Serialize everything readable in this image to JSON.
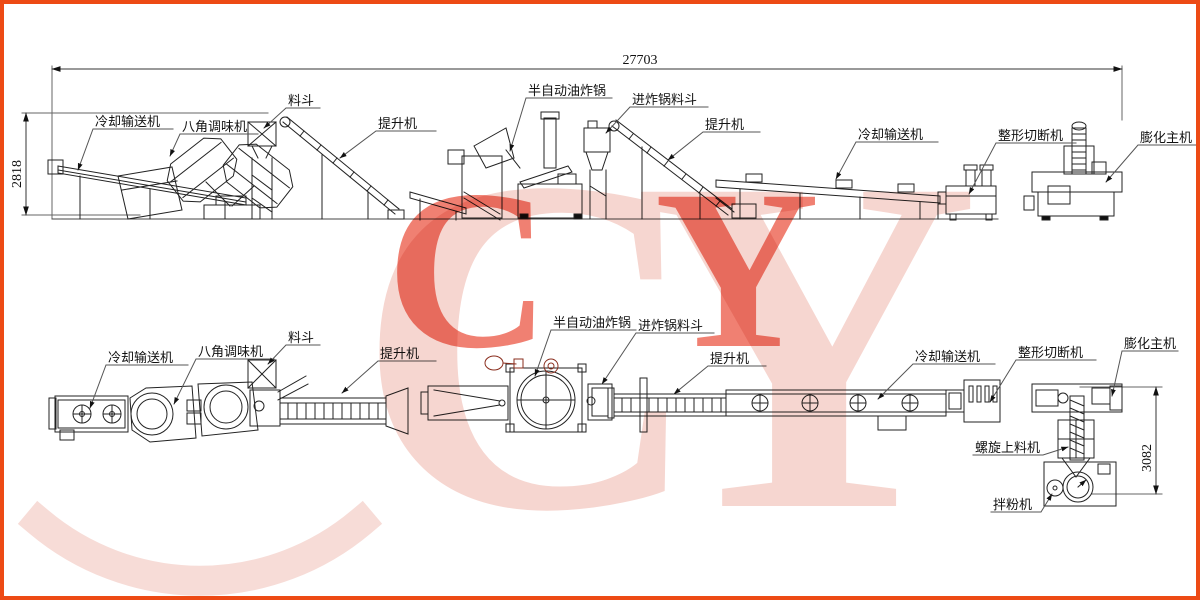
{
  "page": {
    "border_color": "#ed4a15",
    "background_color": "#ffffff",
    "line_color": "#222222",
    "accent_line_color": "#8a2e1e"
  },
  "watermark": {
    "text": "CY",
    "large_color": "#f6d6d0",
    "accent_color": "#ec604e"
  },
  "dimensions": {
    "overall_length": "27703",
    "elevation_height": "2818",
    "plan_right_height": "3082"
  },
  "elevation": {
    "labels": [
      {
        "machine": "cooling-conveyor",
        "text": "冷却输送机"
      },
      {
        "machine": "octagon-seasoning-machine",
        "text": "八角调味机"
      },
      {
        "machine": "hopper",
        "text": "料斗"
      },
      {
        "machine": "elevator-1",
        "text": "提升机"
      },
      {
        "machine": "semi-auto-fryer",
        "text": "半自动油炸锅"
      },
      {
        "machine": "fryer-feed-hopper",
        "text": "进炸锅料斗"
      },
      {
        "machine": "elevator-2",
        "text": "提升机"
      },
      {
        "machine": "cooling-conveyor-2",
        "text": "冷却输送机"
      },
      {
        "machine": "shaping-cutting-machine",
        "text": "整形切断机"
      },
      {
        "machine": "extruder-main-machine",
        "text": "膨化主机"
      }
    ]
  },
  "plan": {
    "labels": [
      {
        "machine": "cooling-conveyor",
        "text": "冷却输送机"
      },
      {
        "machine": "octagon-seasoning-machine",
        "text": "八角调味机"
      },
      {
        "machine": "hopper",
        "text": "料斗"
      },
      {
        "machine": "elevator-1",
        "text": "提升机"
      },
      {
        "machine": "semi-auto-fryer",
        "text": "半自动油炸锅"
      },
      {
        "machine": "fryer-feed-hopper",
        "text": "进炸锅料斗"
      },
      {
        "machine": "elevator-2",
        "text": "提升机"
      },
      {
        "machine": "cooling-conveyor-2",
        "text": "冷却输送机"
      },
      {
        "machine": "shaping-cutting-machine",
        "text": "整形切断机"
      },
      {
        "machine": "extruder-main-machine",
        "text": "膨化主机"
      },
      {
        "machine": "screw-feeder",
        "text": "螺旋上料机"
      },
      {
        "machine": "powder-mixer",
        "text": "拌粉机"
      }
    ]
  }
}
